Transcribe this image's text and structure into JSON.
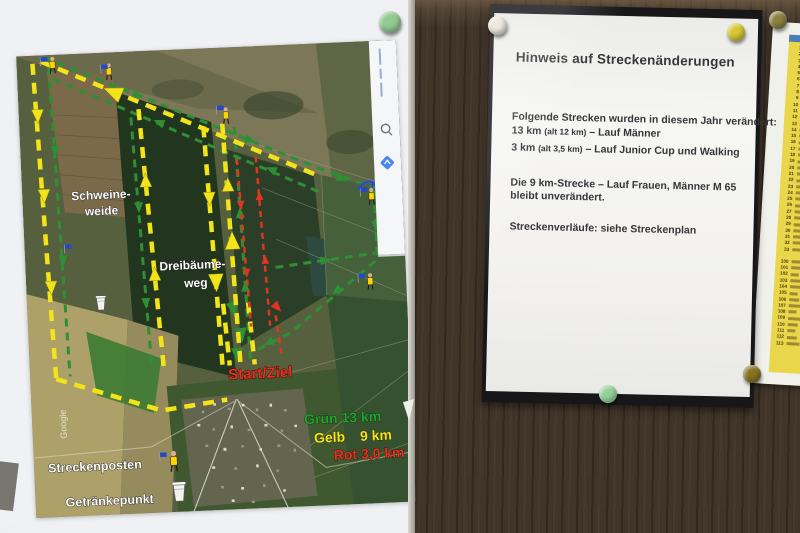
{
  "board": {
    "streckenplan_poster": {
      "map_labels": {
        "schweineweide_line1": "Schweine-",
        "schweineweide_line2": "weide",
        "dreibaeumeweg_line1": "Dreibäume-",
        "dreibaeumeweg_line2": "weg",
        "start_ziel": "Start/Ziel",
        "streckenposten": "Streckenposten",
        "getraenkepunkt": "Getränkepunkt",
        "watermark": "Google"
      },
      "legend": {
        "gruen_label": "Grün 13 km",
        "gelb_label": "Gelb",
        "gelb_value": "9 km",
        "rot_label": "Rot 3,0 km",
        "gruen_color": "#1ea32c",
        "gelb_color": "#f2e418",
        "rot_color": "#e8301c"
      },
      "route_colors": {
        "gruen": "#2f8f35",
        "gelb": "#f2e418",
        "rot": "#e23420"
      },
      "pin_color": "#93c993"
    },
    "notice_sheet": {
      "title": "Hinweis auf Streckenänderungen",
      "intro": "Folgende Strecken wurden in diesem Jahr verändert:",
      "line_13km_pre": "13 km",
      "line_13km_alt": "(alt 12 km)",
      "line_13km_post": "– Lauf Männer",
      "line_3km_pre": "3 km",
      "line_3km_alt": "(alt 3,5 km)",
      "line_3km_post": "– Lauf Junior Cup und Walking",
      "line_9km_a": "Die  9 km-Strecke – Lauf Frauen, Männer M 65",
      "line_9km_b": "bleibt unverändert.",
      "footer": "Streckenverläufe:  siehe Streckenplan",
      "pin_colors": {
        "top_left": "#ece9dd",
        "top_right": "#d6c832",
        "bottom": "#93d198"
      }
    },
    "startlist_sheet": {
      "block1": [
        "1",
        "2",
        "3",
        "4",
        "5",
        "6",
        "7",
        "8",
        "9",
        "10",
        "11",
        "12",
        "13",
        "14",
        "15",
        "16",
        "17",
        "18",
        "19",
        "20",
        "21",
        "22",
        "23",
        "24",
        "25",
        "26",
        "27",
        "28",
        "29",
        "30",
        "31",
        "32",
        "33"
      ],
      "block2": [
        "100",
        "101",
        "102",
        "103",
        "104",
        "105",
        "106",
        "107",
        "108",
        "109",
        "110",
        "111",
        "112",
        "113"
      ],
      "pin_colors": {
        "top": "#8a8040",
        "bottom": "#857322"
      }
    }
  }
}
